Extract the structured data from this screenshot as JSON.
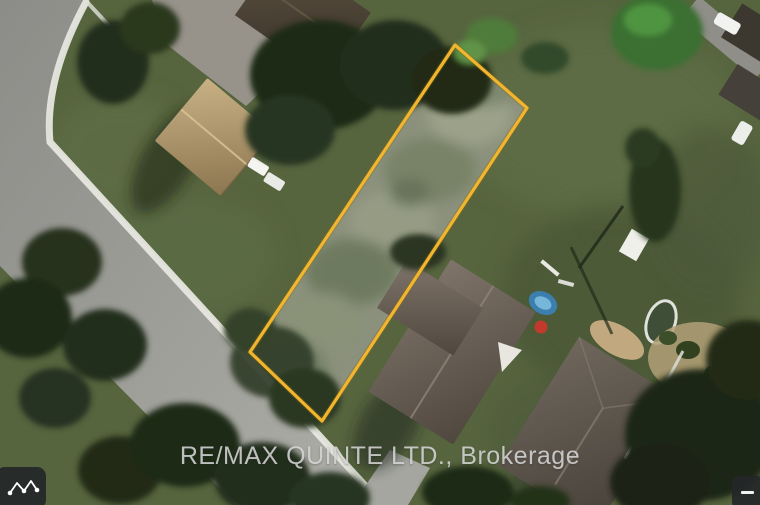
{
  "scene": {
    "kind": "aerial-satellite-photo",
    "watermark_text": "RE/MAX QUINTE LTD., Brokerage"
  },
  "lot_boundary": {
    "points": "455,45 527,108 322,421 250,352",
    "stroke_color": "#F2B52E"
  },
  "controls": {
    "measure_path_button": {
      "icon": "zigzag-polyline-icon"
    },
    "zoom_out_button": {
      "icon": "minus-icon"
    }
  },
  "palette": {
    "grass": "#57653F",
    "road": "#9A9A96",
    "sidewalk": "#E9E9E3",
    "tree_dark": "#202B19",
    "roof_tan": "#BCA378",
    "roof_dark_gray": "#5E564C",
    "pool_blue": "#3C7FAE",
    "ball_red": "#C13A2C",
    "boundary_yellow": "#F2B52E"
  }
}
